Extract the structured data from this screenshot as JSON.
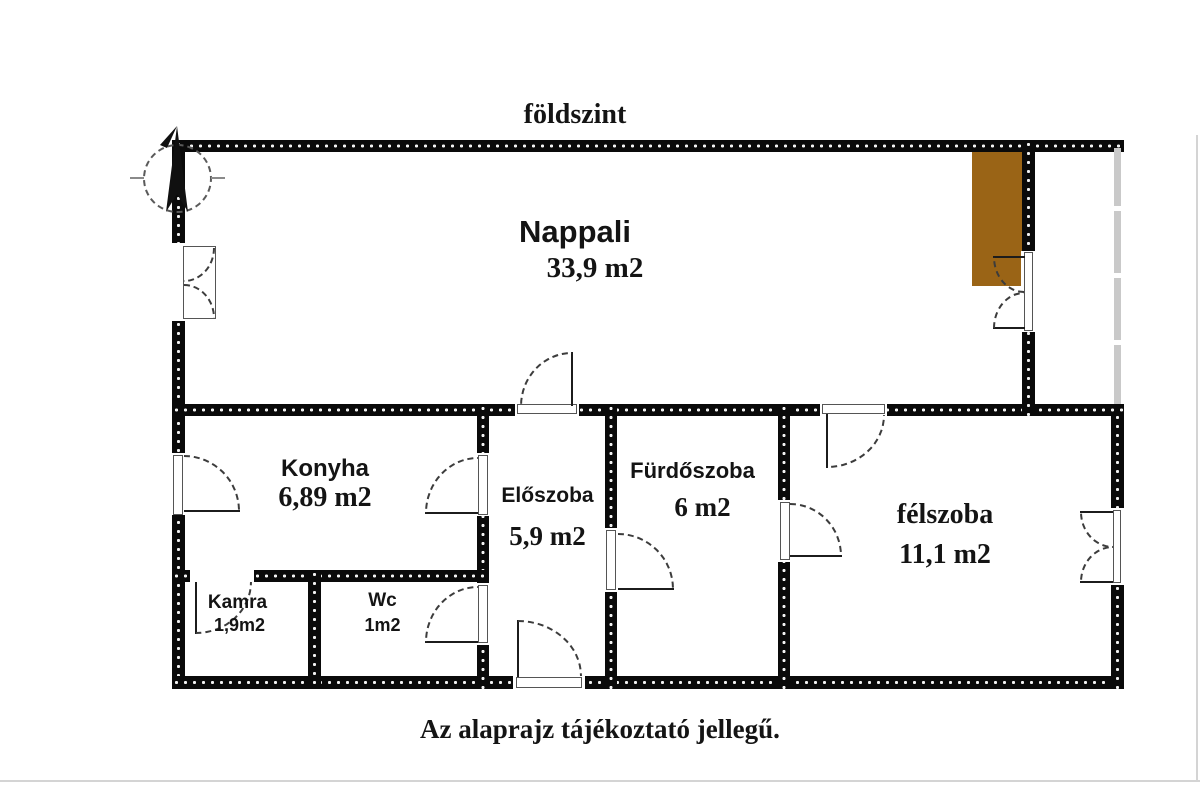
{
  "title": "földszint",
  "footer": "Az alaprajz tájékoztató jellegű.",
  "compass": {
    "direction": "N"
  },
  "rooms": {
    "nappali": {
      "name": "Nappali",
      "area": "33,9 m2"
    },
    "konyha": {
      "name": "Konyha",
      "area": "6,89 m2"
    },
    "eloszoba": {
      "name": "Előszoba",
      "area": "5,9 m2"
    },
    "furdoszoba": {
      "name": "Fürdőszoba",
      "area": "6 m2"
    },
    "kamra": {
      "name": "Kamra",
      "area": "1,9m2"
    },
    "wc": {
      "name": "Wc",
      "area": "1m2"
    },
    "felszoba": {
      "name": "félszoba",
      "area": "11,1 m2"
    }
  },
  "colors": {
    "wall": "#0a0a0a",
    "fireplace": "#9a6416",
    "glazing": "#c9c9c9"
  }
}
